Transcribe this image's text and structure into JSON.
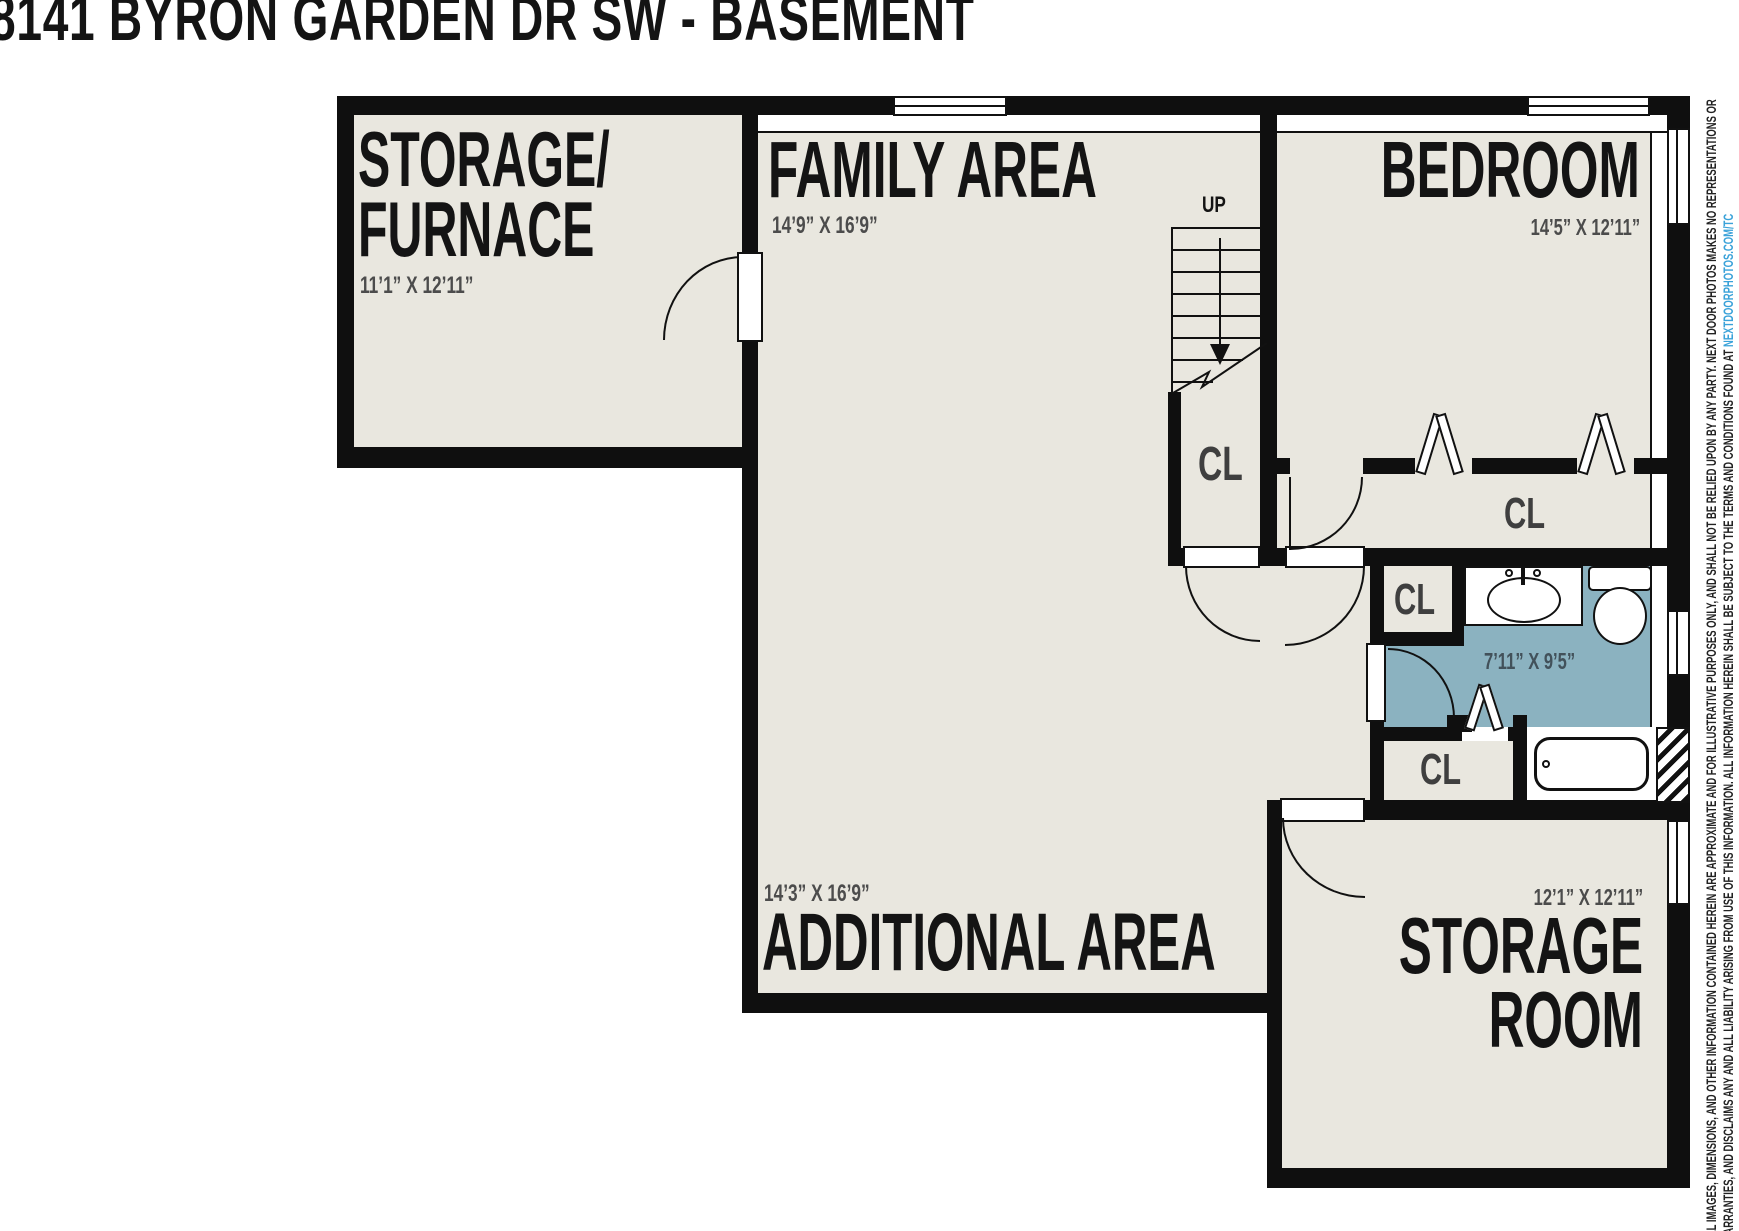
{
  "title": "8141 BYRON GARDEN DR SW - BASEMENT",
  "rooms": {
    "storage_furnace": {
      "name_line1": "STORAGE/",
      "name_line2": "FURNACE",
      "dim": "11’1” X 12’11”"
    },
    "family_area": {
      "name": "FAMILY AREA",
      "dim": "14’9” X 16’9”"
    },
    "bedroom": {
      "name": "BEDROOM",
      "dim": "14’5” X 12’11”"
    },
    "additional_area": {
      "name": "ADDITIONAL AREA",
      "dim": "14’3” X 16’9”"
    },
    "storage_room": {
      "name_line1": "STORAGE",
      "name_line2": "ROOM",
      "dim": "12’1” X 12’11”"
    },
    "bathroom": {
      "dim": "7’11” X 9’5”"
    }
  },
  "labels": {
    "up": "UP",
    "closet": "CL"
  },
  "disclaimer": {
    "line1": "ALL IMAGES, DIMENSIONS, AND OTHER INFORMATION CONTAINED HEREIN ARE APPROXIMATE AND FOR ILLUSTRATIVE PURPOSES ONLY, AND SHALL NOT BE RELIED UPON BY ANY PARTY. NEXT DOOR PHOTOS MAKES NO REPRESENTATIONS OR",
    "line2": "WARRANTIES, AND DISCLAIMS ANY AND ALL LIABILITY ARISING FROM USE OF THIS INFORMATION. ALL INFORMATION HEREIN SHALL BE SUBJECT TO THE TERMS AND CONDITIONS FOUND AT ",
    "link": "NEXTDOORPHOTOS.COM/TC"
  },
  "colors": {
    "floor": "#e9e7df",
    "wall": "#0f0f0f",
    "bathroom": "#8bb2c0",
    "dim_text": "#4c4c4c",
    "link": "#3aa2d9"
  }
}
